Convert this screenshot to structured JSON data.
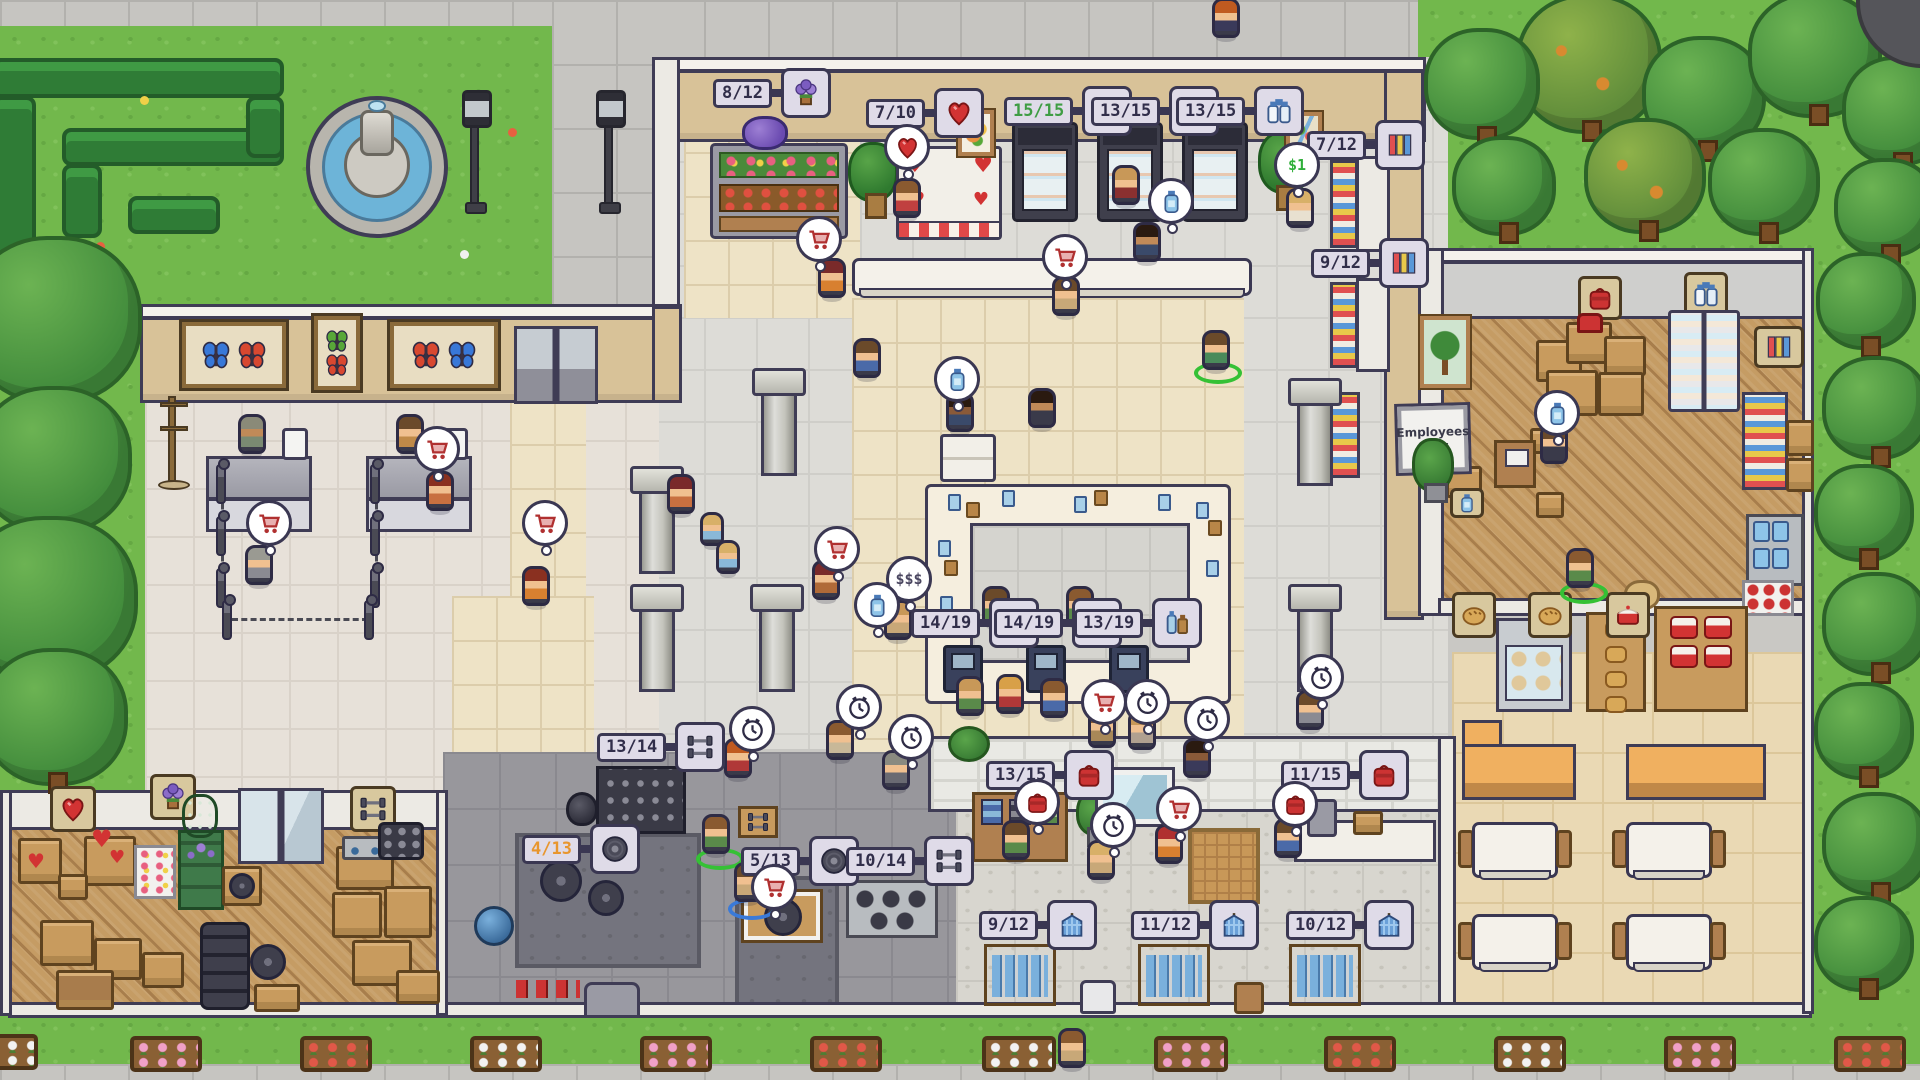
{
  "signs": {
    "employees_only_line1": "Employees",
    "employees_only_line2": "Only"
  },
  "bubbles": {
    "price_text": "$1",
    "chat_text": "$$$"
  },
  "stock_labels": {
    "flowers": {
      "value": "8/12",
      "icon": "flowers-icon",
      "state": "normal"
    },
    "valentine_hearts": {
      "value": "7/10",
      "icon": "heart-icon",
      "state": "normal"
    },
    "fridge_full": {
      "value": "15/15",
      "icon": "milk-bottles-icon",
      "state": "full"
    },
    "fridge_a": {
      "value": "13/15",
      "icon": "milk-bottles-icon",
      "state": "normal"
    },
    "fridge_b": {
      "value": "13/15",
      "icon": "milk-bottles-icon",
      "state": "normal"
    },
    "magazines_a": {
      "value": "7/12",
      "icon": "magazines-icon",
      "state": "normal"
    },
    "magazines_b": {
      "value": "9/12",
      "icon": "magazines-icon",
      "state": "normal"
    },
    "checkout_a": {
      "value": "14/19",
      "icon": "drinks-icon",
      "state": "normal"
    },
    "checkout_b": {
      "value": "14/19",
      "icon": "drinks-icon",
      "state": "normal"
    },
    "checkout_c": {
      "value": "13/19",
      "icon": "drinks-icon",
      "state": "normal"
    },
    "dumbbell_rack": {
      "value": "13/14",
      "icon": "dumbbells-icon",
      "state": "normal"
    },
    "plates_low": {
      "value": "4/13",
      "icon": "weight-plate-icon",
      "state": "low"
    },
    "plates": {
      "value": "5/13",
      "icon": "weight-plate-icon",
      "state": "normal"
    },
    "dumbbells_b": {
      "value": "10/14",
      "icon": "dumbbells-icon",
      "state": "normal"
    },
    "bags_a": {
      "value": "13/15",
      "icon": "gym-bag-icon",
      "state": "normal"
    },
    "bags_b": {
      "value": "11/15",
      "icon": "gym-bag-icon",
      "state": "normal"
    },
    "jerseys_a": {
      "value": "9/12",
      "icon": "jersey-icon",
      "state": "normal"
    },
    "jerseys_b": {
      "value": "11/12",
      "icon": "jersey-icon",
      "state": "normal"
    },
    "jerseys_c": {
      "value": "10/12",
      "icon": "jersey-icon",
      "state": "normal"
    }
  },
  "palette": {
    "grass": "#72b84c",
    "pavement": "#c6c5c1",
    "store_floor": "#dddcd7",
    "cream_tile": "#eee3c6",
    "wood_floor": "#c59c64",
    "gym_mat": "#74747e",
    "wall_tan": "#d8c298",
    "label_bg": "#dfdbe8",
    "label_border": "#3a3752",
    "stock_full_text": "#3f9d44",
    "stock_low_text": "#e8962e",
    "accent_red": "#cc3333",
    "water": "#6db4d8",
    "highlight_ring": "#35c135"
  }
}
